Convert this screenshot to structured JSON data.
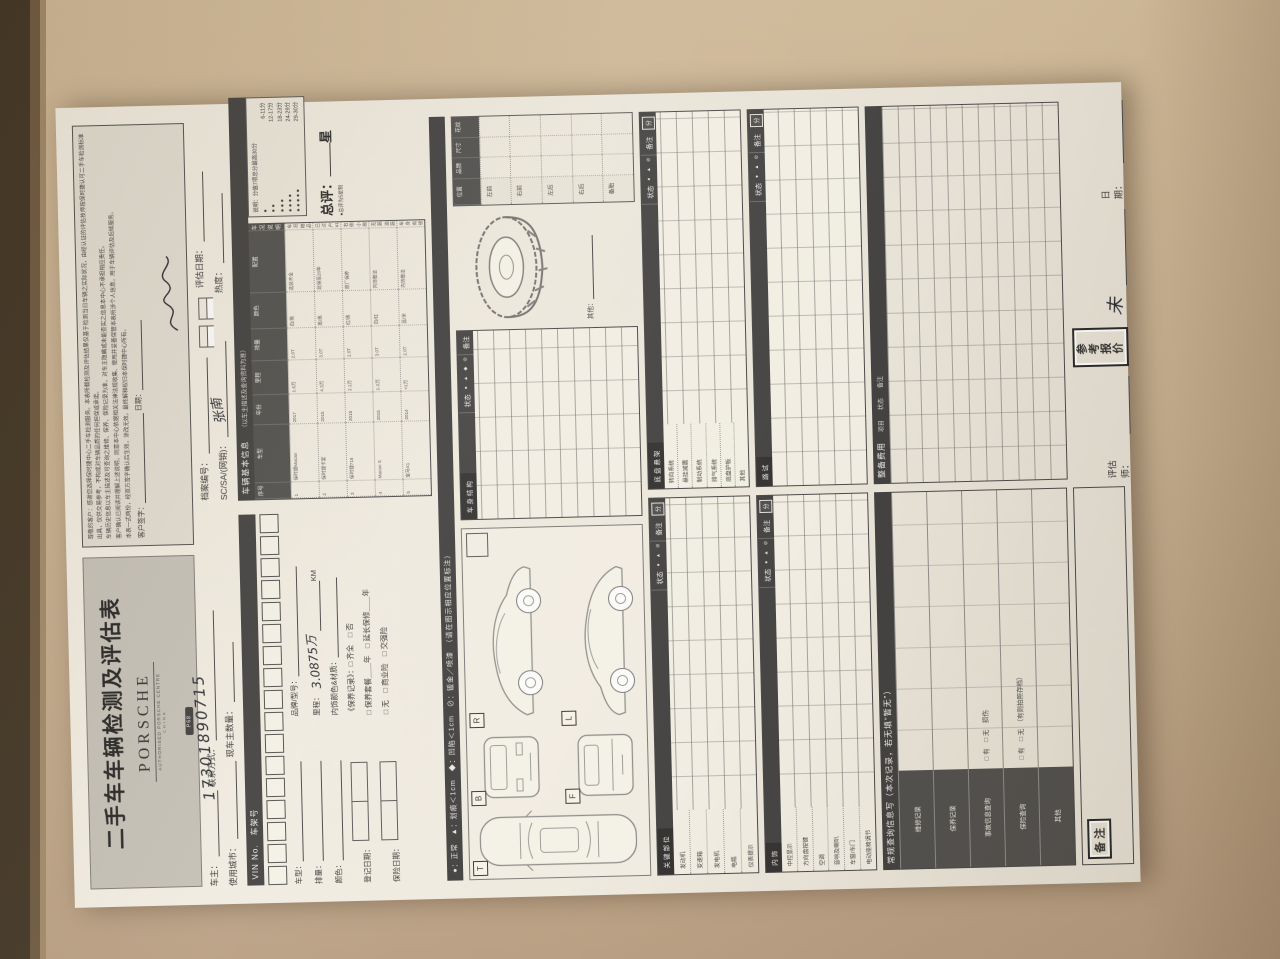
{
  "colors": {
    "desk": "#c9b292",
    "paper": "#eae8e3",
    "bar": "#3c3c3c",
    "ink": "#23262e"
  },
  "header": {
    "title": "二手车车辆检测及评估表",
    "brand": "PORSCHE",
    "brand_sub": "AUTHORISED PORSCHE CENTRE",
    "brand_sub2": "CHINA",
    "badge": "P68"
  },
  "disclaimer": {
    "lines": [
      "尊敬的客户：感谢您选择保时捷中心二手车检测服务。本表所载检测及评估结果仅基于检测当日车辆之实际状况，由经认证的评估技师按保时捷认可二手车检测标准出具，仅供交易参考，不构成对车辆品质的任何担保或承诺。",
      "车辆历史信息以车主描述及可查询之维修、保养、保险记录为准，对车主隐瞒或未能查实之信息本中心不承担相应责任。",
      "客户确认已阅读并理解上述说明，同意本中心依据相关法律法规收集、使用并妥善保管本表所涉个人信息，用于车辆评估及后续服务。",
      "本表一式两份，经双方签字确认后生效，涂改无效。最终解释权归本保时捷中心所有。"
    ],
    "sign_label": "客户签字：",
    "date_label": "日期："
  },
  "fields": {
    "owner_label": "车主：",
    "contact_label": "联系方式：",
    "phone": "17301890715",
    "city_label": "使用城市：",
    "owners_count_label": "现车主数量：",
    "file_no_label": "档案编号：",
    "eval_date_label": "评估日期：",
    "sc_label": "SC/SA/(网销)：",
    "sc_signature": "张南",
    "heat_label": "热度："
  },
  "basic": {
    "bar_title": "车辆基本信息",
    "bar_sub": "（以车主描述及查询资料为准）",
    "columns": [
      "序号",
      "车型",
      "年份",
      "里程",
      "排量",
      "颜色",
      "配置",
      "车况说明"
    ],
    "rows": [
      [
        "1",
        "保时捷Macan",
        "2017",
        "1.6万",
        "2.0T",
        "白/黑",
        "选装齐全",
        "车况精品 无事故"
      ],
      [
        "2",
        "保时捷卡宴",
        "2015",
        "4.3万",
        "3.0T",
        "黑/黑",
        "延保至20年",
        "已过户 ¥10.2万"
      ],
      [
        "3",
        "保时捷718",
        "2016",
        "2.1万",
        "2.0T",
        "红/黑",
        "原厂保养",
        "右侧小剐蹭已处理"
      ],
      [
        "4",
        "Macan S",
        "2015",
        "1-2万",
        "3.0T",
        "白/红",
        "内饰整洁",
        "无漏油漏水"
      ],
      [
        "5",
        "宝马X1",
        "2014",
        "<1万",
        "2.0T",
        "蓝/米",
        "内饰整洁",
        "车身有锈蚀"
      ]
    ]
  },
  "rating": {
    "note": "说明：分值7项总分最高30分",
    "scale": [
      {
        "dots": "●",
        "range": "6-11分"
      },
      {
        "dots": "● ●",
        "range": "12-17分"
      },
      {
        "dots": "● ● ●",
        "range": "18-23分"
      },
      {
        "dots": "● ● ● ●",
        "range": "24-29分"
      },
      {
        "dots": "● ● ● ● ●",
        "range": "29-30分"
      }
    ],
    "overall_label": "总评：",
    "overall_suffix": "星",
    "overall_note": "●总评为5星制"
  },
  "legend": "●：正常　▲：划痕＜1cm　◆：凹陷＜1cm　⊘：钣金／喷漆　（请在图示相应位置标注）",
  "vin": {
    "bar": "VIN No.　车架号"
  },
  "vehicle": {
    "model_label": "车型：",
    "displacement_label": "排量：",
    "color_label": "颜色：",
    "reg_date_label": "登记日期：",
    "insurance_date_label": "保险日期：",
    "brand_model_label": "品牌/型号：",
    "mileage_label": "里程：",
    "mileage_value": "3.0875万",
    "mileage_unit": "KM",
    "interior_label": "内饰颜色&材质：",
    "maintenance_label": "《保养记录》：",
    "maintenance_opts": "□ 齐全　□ 否",
    "warranty_line": "□ 保养套餐＿＿年　□ 延长保修＿＿年",
    "insurance_opts": "□ 无　□ 商业险　□ 交强险"
  },
  "diagram": {
    "top": "T",
    "front": "B",
    "rear": "F",
    "side_right": "R",
    "side_left": "L"
  },
  "body_structure": {
    "title": "车身结构",
    "status": "状态",
    "symbols": "● ▲ ◆ ⊘",
    "remark": "备注"
  },
  "tires": {
    "title": "轮胎",
    "cols": [
      "位置",
      "品牌",
      "尺寸",
      "花纹"
    ],
    "rows": [
      "左前",
      "右前",
      "左后",
      "右后",
      "备胎"
    ],
    "other": "其他："
  },
  "key_parts": {
    "title": "关键部位",
    "status": "状态",
    "symbols": "● ▲ ⊘",
    "remark": "备注",
    "score": "分",
    "rows": [
      "发动机",
      "变速箱",
      "发电机",
      "电瓶",
      "仪表提示"
    ]
  },
  "chassis": {
    "title": "底盘悬架",
    "status": "状态",
    "symbols": "● ▲ ⊘",
    "remark": "备注",
    "score": "分",
    "rows": [
      "转向系统",
      "悬挂减震",
      "制动系统",
      "排气系统",
      "底盘护板",
      "其他"
    ]
  },
  "interior": {
    "title": "内饰",
    "status": "状态",
    "symbols": "● ▲ ⊘",
    "remark": "备注",
    "score": "分",
    "rows": [
      "中控显示",
      "方向盘按键",
      "空调",
      "音响及喇叭",
      "车窗/车门",
      "电动座椅调节"
    ]
  },
  "road_test": {
    "title": "路试",
    "status": "状态",
    "symbols": "● ▲ ⊘",
    "remark": "备注",
    "score": "分"
  },
  "query": {
    "bar": "常规查询信息写（本次记录，若无填“暂无”）",
    "rows": [
      "维修记录",
      "保养记录",
      "事故信息查询",
      "保险查询",
      "其他"
    ],
    "opt_accident": "□ 有　□ 无　损伤",
    "opt_insurance": "□ 有　□ 无　（有则拍照存档）"
  },
  "recondition": {
    "bar_title": "整备费用",
    "cols": [
      "项目",
      "状态",
      "备注"
    ]
  },
  "footer": {
    "remark_box": "备注",
    "assessor_label": "评估师：",
    "price_box_l1": "参考",
    "price_box_l2": "报价",
    "price_hw": "未",
    "date_label": "日期："
  }
}
